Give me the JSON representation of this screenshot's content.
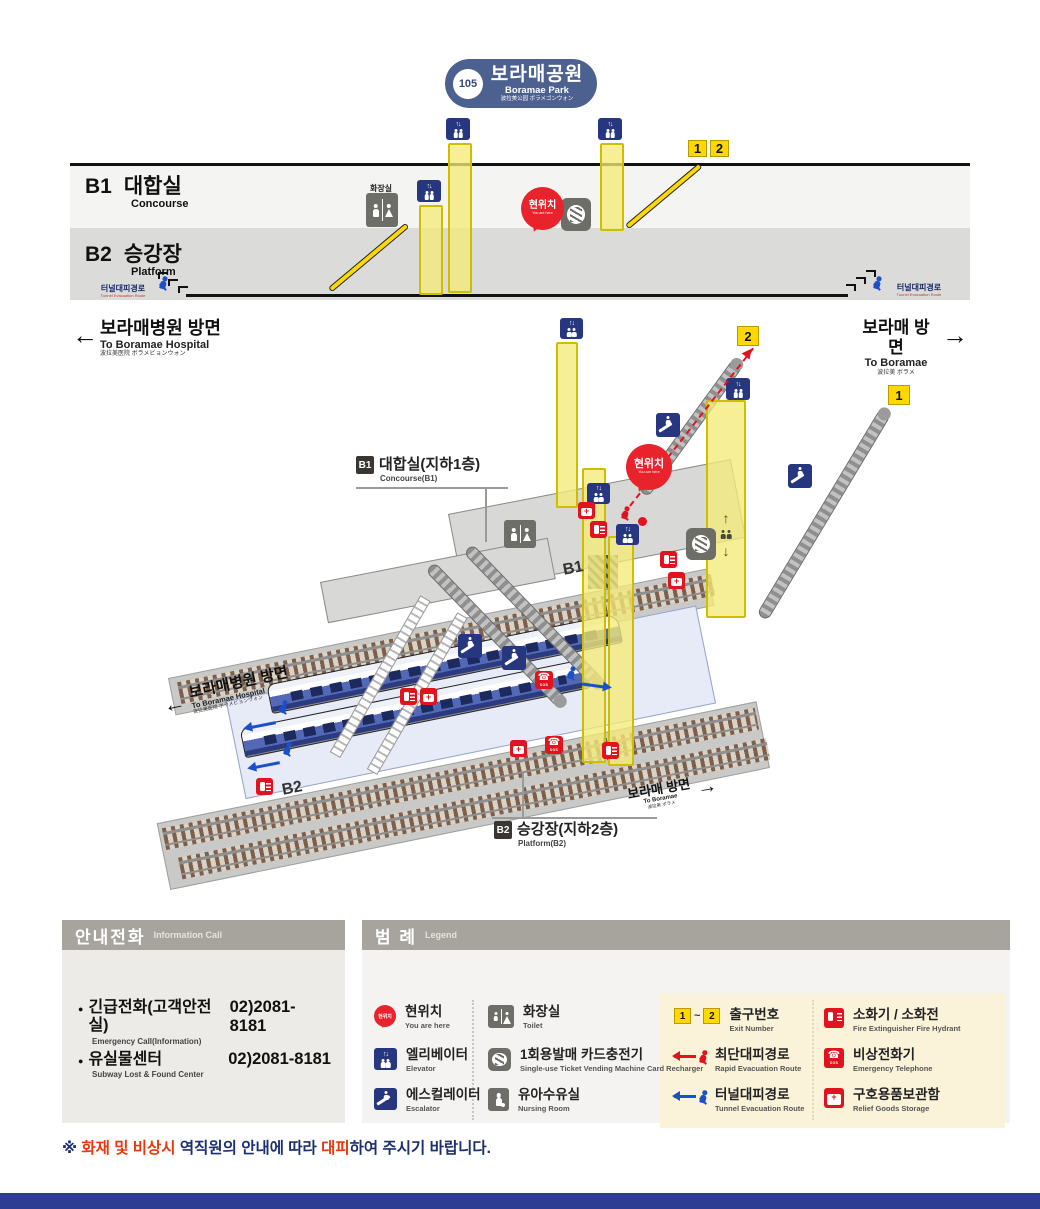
{
  "station": {
    "number": "105",
    "name_ko": "보라매공원",
    "name_en": "Boramae Park",
    "name_cjk": "波拉美公园  ボラメゴンウォン"
  },
  "cross_section": {
    "b1_code": "B1",
    "b1_ko": "대합실",
    "b1_en": "Concourse",
    "b2_code": "B2",
    "b2_ko": "승강장",
    "b2_en": "Platform",
    "toilet_ko": "화장실",
    "you_are_here_ko": "현위치",
    "you_are_here_en": "You are here",
    "tunnel_ko": "터널대피경로",
    "tunnel_en": "Tunnel Evacuation Route",
    "exit_1": "1",
    "exit_2": "2"
  },
  "directions": {
    "left_ko": "보라매병원 방면",
    "left_en": "To Boramae Hospital",
    "left_cjk": "波拉美医院  ボラメビョンウォン",
    "right_ko": "보라매 방면",
    "right_en": "To Boramae",
    "right_cjk": "波拉美  ボラメ"
  },
  "iso": {
    "b1_code": "B1",
    "b1_title": "대합실(지하1층)",
    "b1_sub": "Concourse(B1)",
    "b2_code": "B2",
    "b2_title": "승강장(지하2층)",
    "b2_sub": "Platform(B2)",
    "b1_floor": "B1",
    "b2_floor": "B2",
    "you_are_here_ko": "현위치",
    "you_are_here_en": "You are here",
    "exit_1": "1",
    "exit_2": "2"
  },
  "info_panel": {
    "title_ko": "안내전화",
    "title_en": "Information Call",
    "rows": [
      {
        "ko": "긴급전화(고객안전실)",
        "en": "Emergency Call(Information)",
        "phone": "02)2081-8181"
      },
      {
        "ko": "유실물센터",
        "en": "Subway Lost & Found Center",
        "phone": "02)2081-8181"
      }
    ]
  },
  "legend": {
    "title_ko": "범 례",
    "title_en": "Legend",
    "balloon_ko": "현위치",
    "sos": "SOS",
    "col_a": [
      {
        "ko": "현위치",
        "en": "You are here"
      },
      {
        "ko": "엘리베이터",
        "en": "Elevator"
      },
      {
        "ko": "에스컬레이터",
        "en": "Escalator"
      }
    ],
    "col_b": [
      {
        "ko": "화장실",
        "en": "Toilet"
      },
      {
        "ko": "1회용발매 카드충전기",
        "en": "Single-use Ticket Vending Machine Card Recharger"
      },
      {
        "ko": "유아수유실",
        "en": "Nursing Room"
      }
    ],
    "col_c": [
      {
        "ko": "출구번호",
        "en": "Exit Number",
        "badge_from": "1",
        "badge_to": "2"
      },
      {
        "ko": "최단대피경로",
        "en": "Rapid Evacuation Route"
      },
      {
        "ko": "터널대피경로",
        "en": "Tunnel Evacuation Route"
      }
    ],
    "col_d": [
      {
        "ko": "소화기 / 소화전",
        "en": "Fire Extinguisher   Fire Hydrant"
      },
      {
        "ko": "비상전화기",
        "en": "Emergency Telephone"
      },
      {
        "ko": "구호용품보관함",
        "en": "Relief Goods Storage"
      }
    ]
  },
  "footer": {
    "mark": "※ ",
    "red1": "화재 및 비상시",
    "mid": " 역직원의 안내에 따라 ",
    "red2": "대피",
    "tail": "하여 주시기 바랍니다."
  },
  "glyphs": {
    "left_arrow": "←",
    "right_arrow": "→",
    "up_arrow": "↑",
    "down_arrow": "↓",
    "updown": "↑↓",
    "phone": "☎",
    "bullet": "●",
    "tilde": "~",
    "plus": "+"
  },
  "colors": {
    "navy": "#26367f",
    "red": "#e0131e",
    "yellow": "#ffd800",
    "title_pill": "#4d6191",
    "cream": "#faf3d9",
    "panel_header": "#a7a39d",
    "footer_navy": "#1c2f6e",
    "footer_red": "#e8380d"
  }
}
